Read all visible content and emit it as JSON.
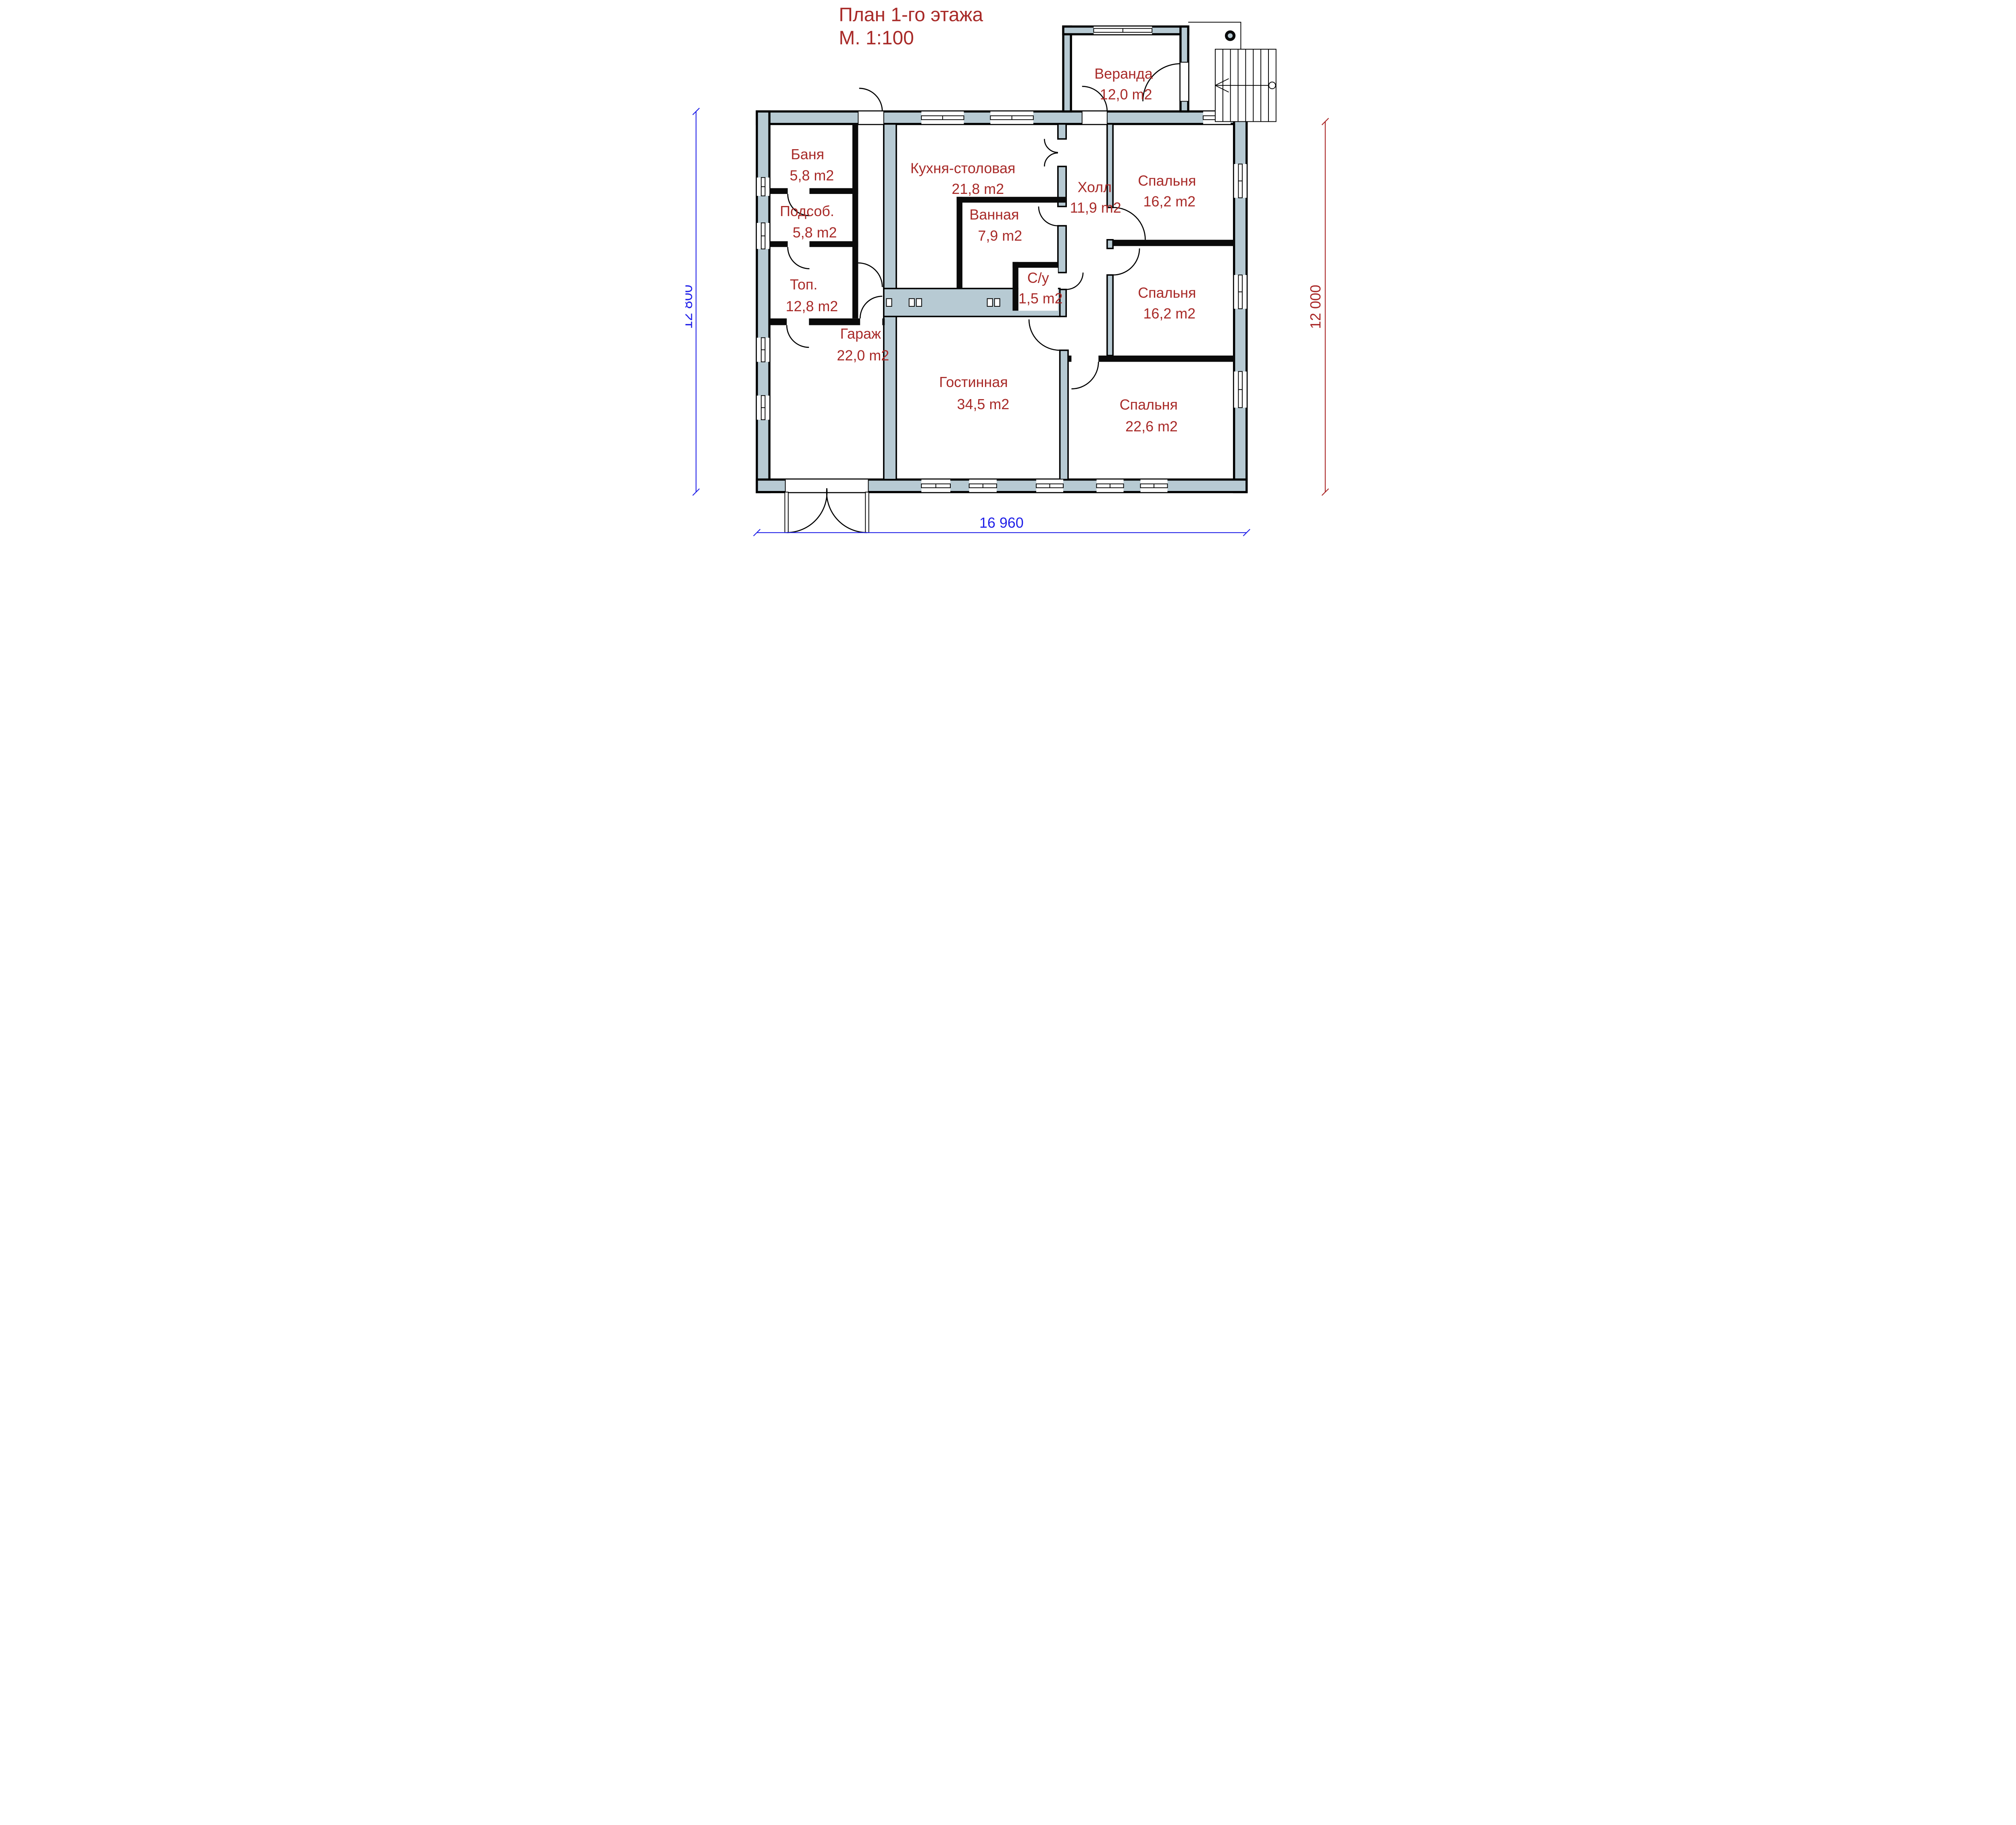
{
  "title": {
    "line1": "План 1-го этажа",
    "line2": "М. 1:100"
  },
  "rooms": [
    {
      "name": "Веранда",
      "area": "12,0 m2"
    },
    {
      "name": "Баня",
      "area": "5,8 m2"
    },
    {
      "name": "Подсоб.",
      "area": "5,8 m2"
    },
    {
      "name": "Топ.",
      "area": "12,8 m2"
    },
    {
      "name": "Гараж",
      "area": "22,0 m2"
    },
    {
      "name": "Кухня-столовая",
      "area": "21,8 m2"
    },
    {
      "name": "Ванная",
      "area": "7,9 m2"
    },
    {
      "name": "С/у",
      "area": "1,5 m2"
    },
    {
      "name": "Холл",
      "area": "11,9 m2"
    },
    {
      "name": "Спальня",
      "area": "16,2 m2"
    },
    {
      "name": "Спальня",
      "area": "16,2 m2"
    },
    {
      "name": "Гостинная",
      "area": "34,5 m2"
    },
    {
      "name": "Спальня",
      "area": "22,6 m2"
    }
  ],
  "dimensions": {
    "left": "12 800",
    "right": "12 000",
    "bottom": "16 960"
  },
  "colors": {
    "wall_fill": "#b7cad3",
    "line": "#000000",
    "label_red": "#a82a28",
    "dim_blue": "#2020e8",
    "dim_red": "#a82525",
    "background": "#ffffff"
  }
}
